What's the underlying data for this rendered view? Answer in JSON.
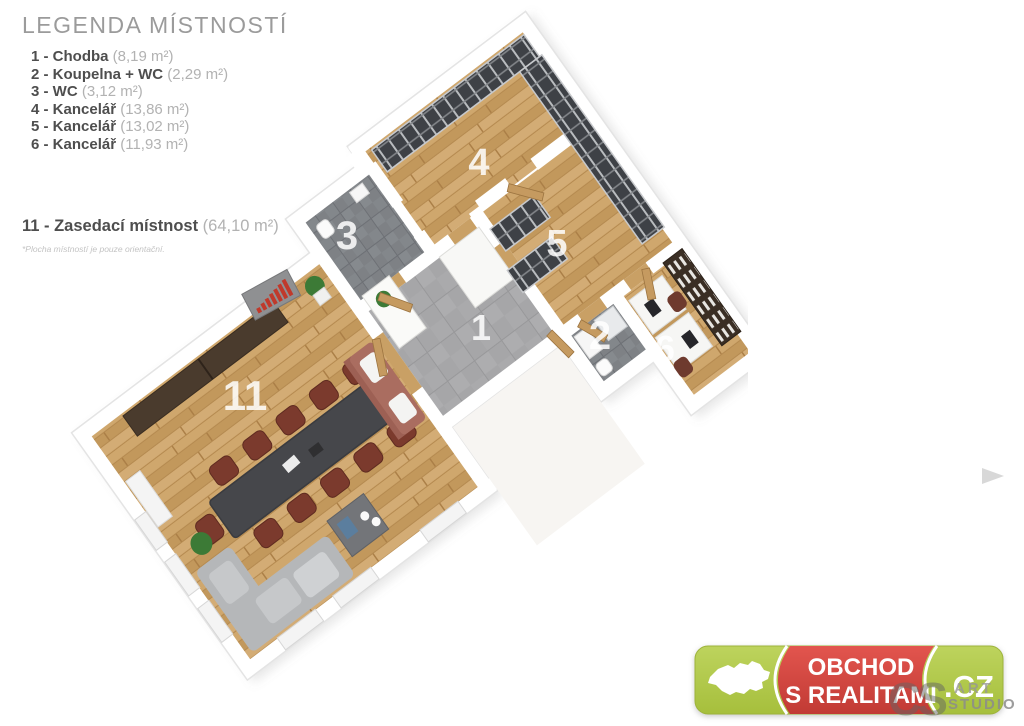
{
  "legend": {
    "title": "LEGENDA MÍSTNOSTÍ",
    "items": [
      {
        "label": "1 - Chodba",
        "area": "(8,19 m²)"
      },
      {
        "label": "2 - Koupelna + WC",
        "area": "(2,29 m²)"
      },
      {
        "label": "3 - WC",
        "area": "(3,12 m²)"
      },
      {
        "label": "4 - Kancelář",
        "area": "(13,86 m²)"
      },
      {
        "label": "5 - Kancelář",
        "area": "(13,02 m²)"
      },
      {
        "label": "6 - Kancelář",
        "area": "(11,93 m²)"
      }
    ],
    "special": {
      "label": "11 - Zasedací místnost",
      "area": "(64,10 m²)"
    },
    "footnote": "*Plocha místností je pouze orientační."
  },
  "plan": {
    "labels": {
      "r1": "1",
      "r2": "2",
      "r3": "3",
      "r4": "4",
      "r5": "5",
      "r6": "6",
      "r11": "11"
    }
  },
  "logo": {
    "line1": "OBCHOD",
    "line2": "S REALITAMI",
    "tld": ".CZ"
  },
  "watermark": {
    "ghost": "CS",
    "line1": "ART",
    "line2": "STUDIO"
  },
  "colors": {
    "wood": "#c9a065",
    "tile_gray": "#a6a6a8",
    "tile_dark": "#7e8185",
    "logo_green": "#b5cc52",
    "logo_red": "#d8453e",
    "chart_red": "#c0392b"
  }
}
